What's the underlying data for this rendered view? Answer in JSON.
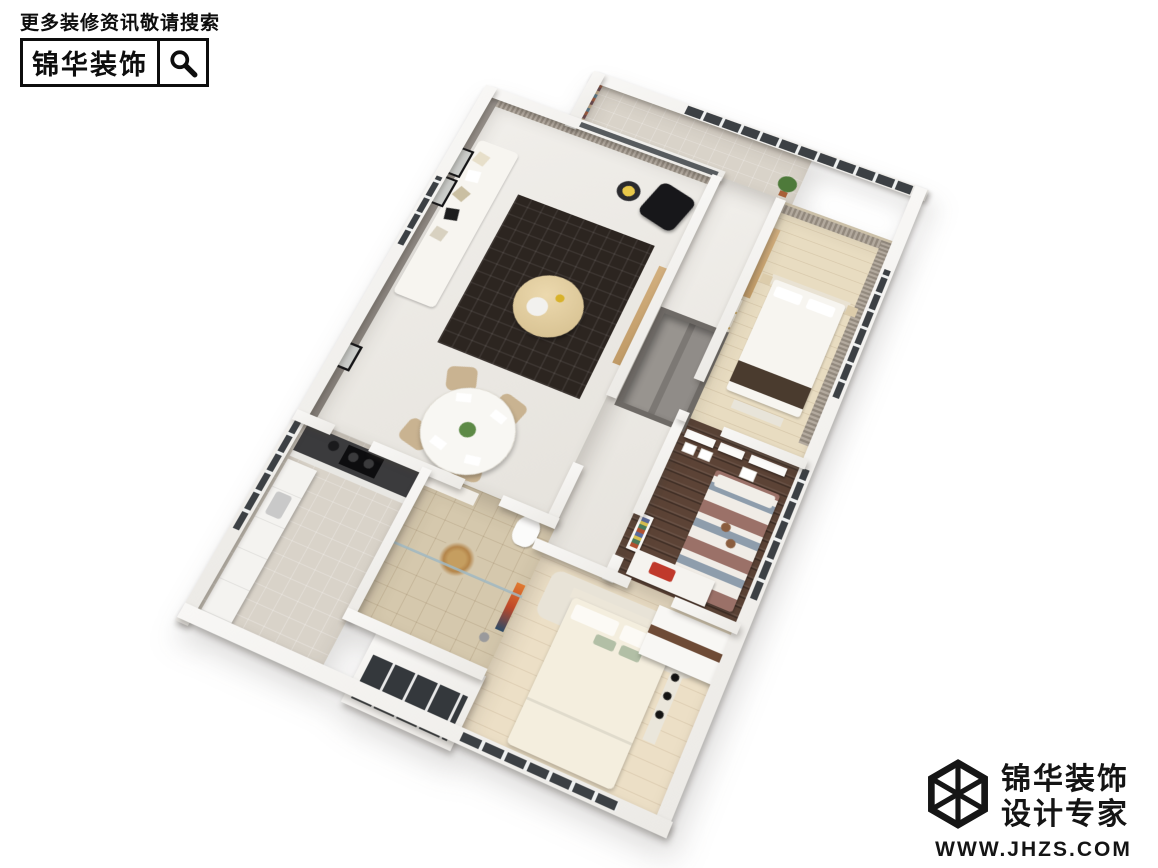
{
  "image_type": "3d-apartment-dollhouse-render",
  "watermark_top_left": {
    "tagline": "更多装修资讯敬请搜索",
    "brand": "锦华装饰",
    "icon": "magnifier-icon"
  },
  "watermark_bottom_right": {
    "brand": "锦华装饰",
    "subtitle": "设计专家",
    "website": "WWW.JHZS.COM",
    "icon": "hex-cube-logo-icon"
  },
  "palette": {
    "background": "#ffffff",
    "wall_white": "#f6f5f2",
    "wall_gray": "#8b8680",
    "marble_floor": "#edebe7",
    "wood_light": "#e8dcc1",
    "wood_dark": "#5c4336",
    "tile_beige": "#d5c8ad",
    "rug_dark": "#2c2520",
    "curtain_taupe": "#9a9187",
    "sofa_white": "#f7f5f0",
    "accent_gold": "#cfa85c",
    "accent_red": "#c0392b",
    "glass_dark": "#3c4044"
  },
  "scene": {
    "description": "Axonometric cutaway render of a furnished apartment, viewed from above at an angle on a white background",
    "rooms": [
      {
        "name": "balcony",
        "floor": "tile"
      },
      {
        "name": "living-room",
        "floor": "marble"
      },
      {
        "name": "dining-room",
        "floor": "marble"
      },
      {
        "name": "corridor",
        "floor": "marble"
      },
      {
        "name": "foyer-closet",
        "floor": "gray"
      },
      {
        "name": "master-bedroom",
        "floor": "light-wood"
      },
      {
        "name": "kids-room",
        "floor": "dark-walnut"
      },
      {
        "name": "bedroom",
        "floor": "light-wood"
      },
      {
        "name": "kitchen",
        "floor": "tile"
      },
      {
        "name": "bathroom",
        "floor": "beige-tile"
      },
      {
        "name": "bay-window",
        "floor": "none"
      }
    ]
  }
}
